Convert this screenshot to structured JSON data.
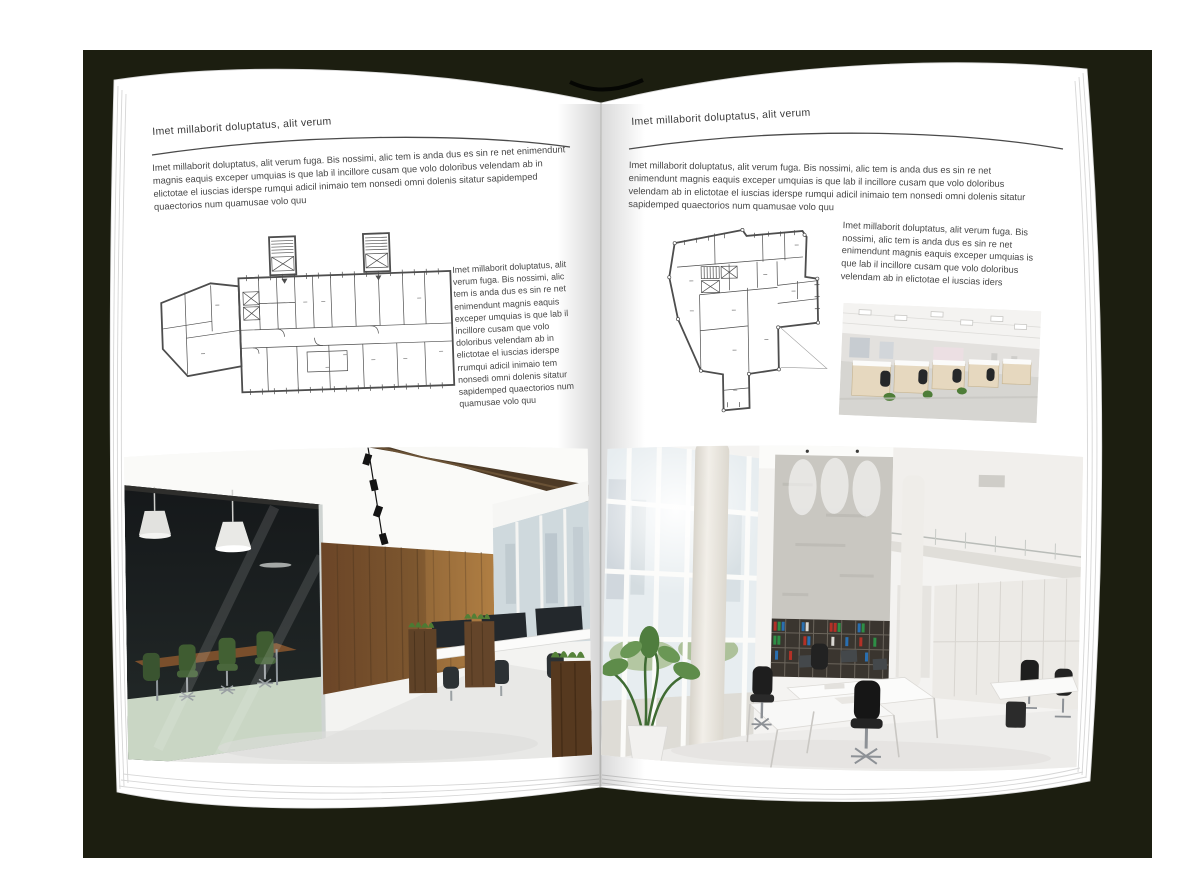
{
  "colors": {
    "canvas": "#ffffff",
    "cover": "#1c1e10",
    "page": "#ffffff",
    "text": "#474747",
    "rule": "#4a4a4a"
  },
  "page_left": {
    "header": "Imet millaborit doluptatus, alit verum",
    "intro": "Imet millaborit doluptatus, alit verum fuga. Bis nossimi, alic tem is anda dus es sin re net enimendunt magnis eaquis exceper umquias is que lab il incillore cusam que volo doloribus velendam ab in elictotae el iuscias iderspe rumqui adicil inimaio tem nonsedi omni dolenis sitatur sapidemped quaectorios num quamusae volo quu",
    "side_text": "Imet millaborit doluptatus, alit verum fuga. Bis nossimi, alic tem is anda dus es sin re net enimendunt magnis eaquis exceper umquias is que lab il incillore cusam que volo doloribus velendam ab in elictotae el iuscias iderspe rrumqui adicil inimaio tem nonsedi omni dolenis sitatur sapidemped quaectorios num quamusae volo quu",
    "figures": {
      "floor_plan": "wide-building-floor-plan",
      "photo": "loft-office-interior-photo"
    }
  },
  "page_right": {
    "header": "Imet millaborit doluptatus, alit verum",
    "intro": "Imet millaborit doluptatus, alit verum fuga. Bis nossimi, alic tem is anda dus es sin re net enimendunt magnis eaquis exceper umquias is que lab il incillore cusam que volo doloribus velendam ab in elictotae el iuscias iderspe rumqui adicil inimaio tem nonsedi omni dolenis sitatur sapidemped quaectorios num quamusae volo quu",
    "side_text": "Imet millaborit doluptatus, alit verum fuga. Bis nossimi, alic tem is anda dus es sin re net enimendunt magnis eaquis exceper umquias is que lab il incillore cusam que volo doloribus velendam ab in elictotae el iuscias iders",
    "figures": {
      "floor_plan": "irregular-building-floor-plan",
      "photo_small": "open-plan-cubicle-office-photo",
      "photo_large": "bright-atrium-office-photo"
    }
  }
}
